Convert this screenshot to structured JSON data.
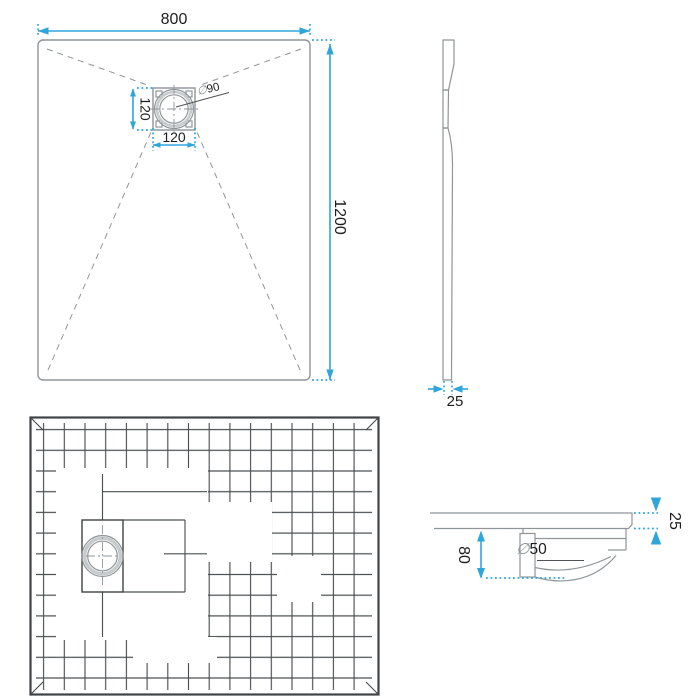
{
  "colors": {
    "dimension_accent": "#2fa5da",
    "drawing_line": "#8f9599",
    "light_ring": "#c6cacc",
    "grid_line": "#4c5052",
    "frame_line": "#3f4345",
    "leader_line": "#4f5355",
    "text": "#1c1c1c",
    "diameter_symbol": "#8a9093"
  },
  "dimensions": {
    "top_view": {
      "width": "800",
      "height": "1200",
      "drain_width": "120",
      "drain_height": "120",
      "drain_diameter_symbol": "∅",
      "drain_diameter_value": "90"
    },
    "side_view": {
      "thickness": "25"
    },
    "section_view": {
      "tray_thickness": "25",
      "drain_depth": "80",
      "pipe_diameter_symbol": "∅",
      "pipe_diameter_value": "50"
    }
  }
}
